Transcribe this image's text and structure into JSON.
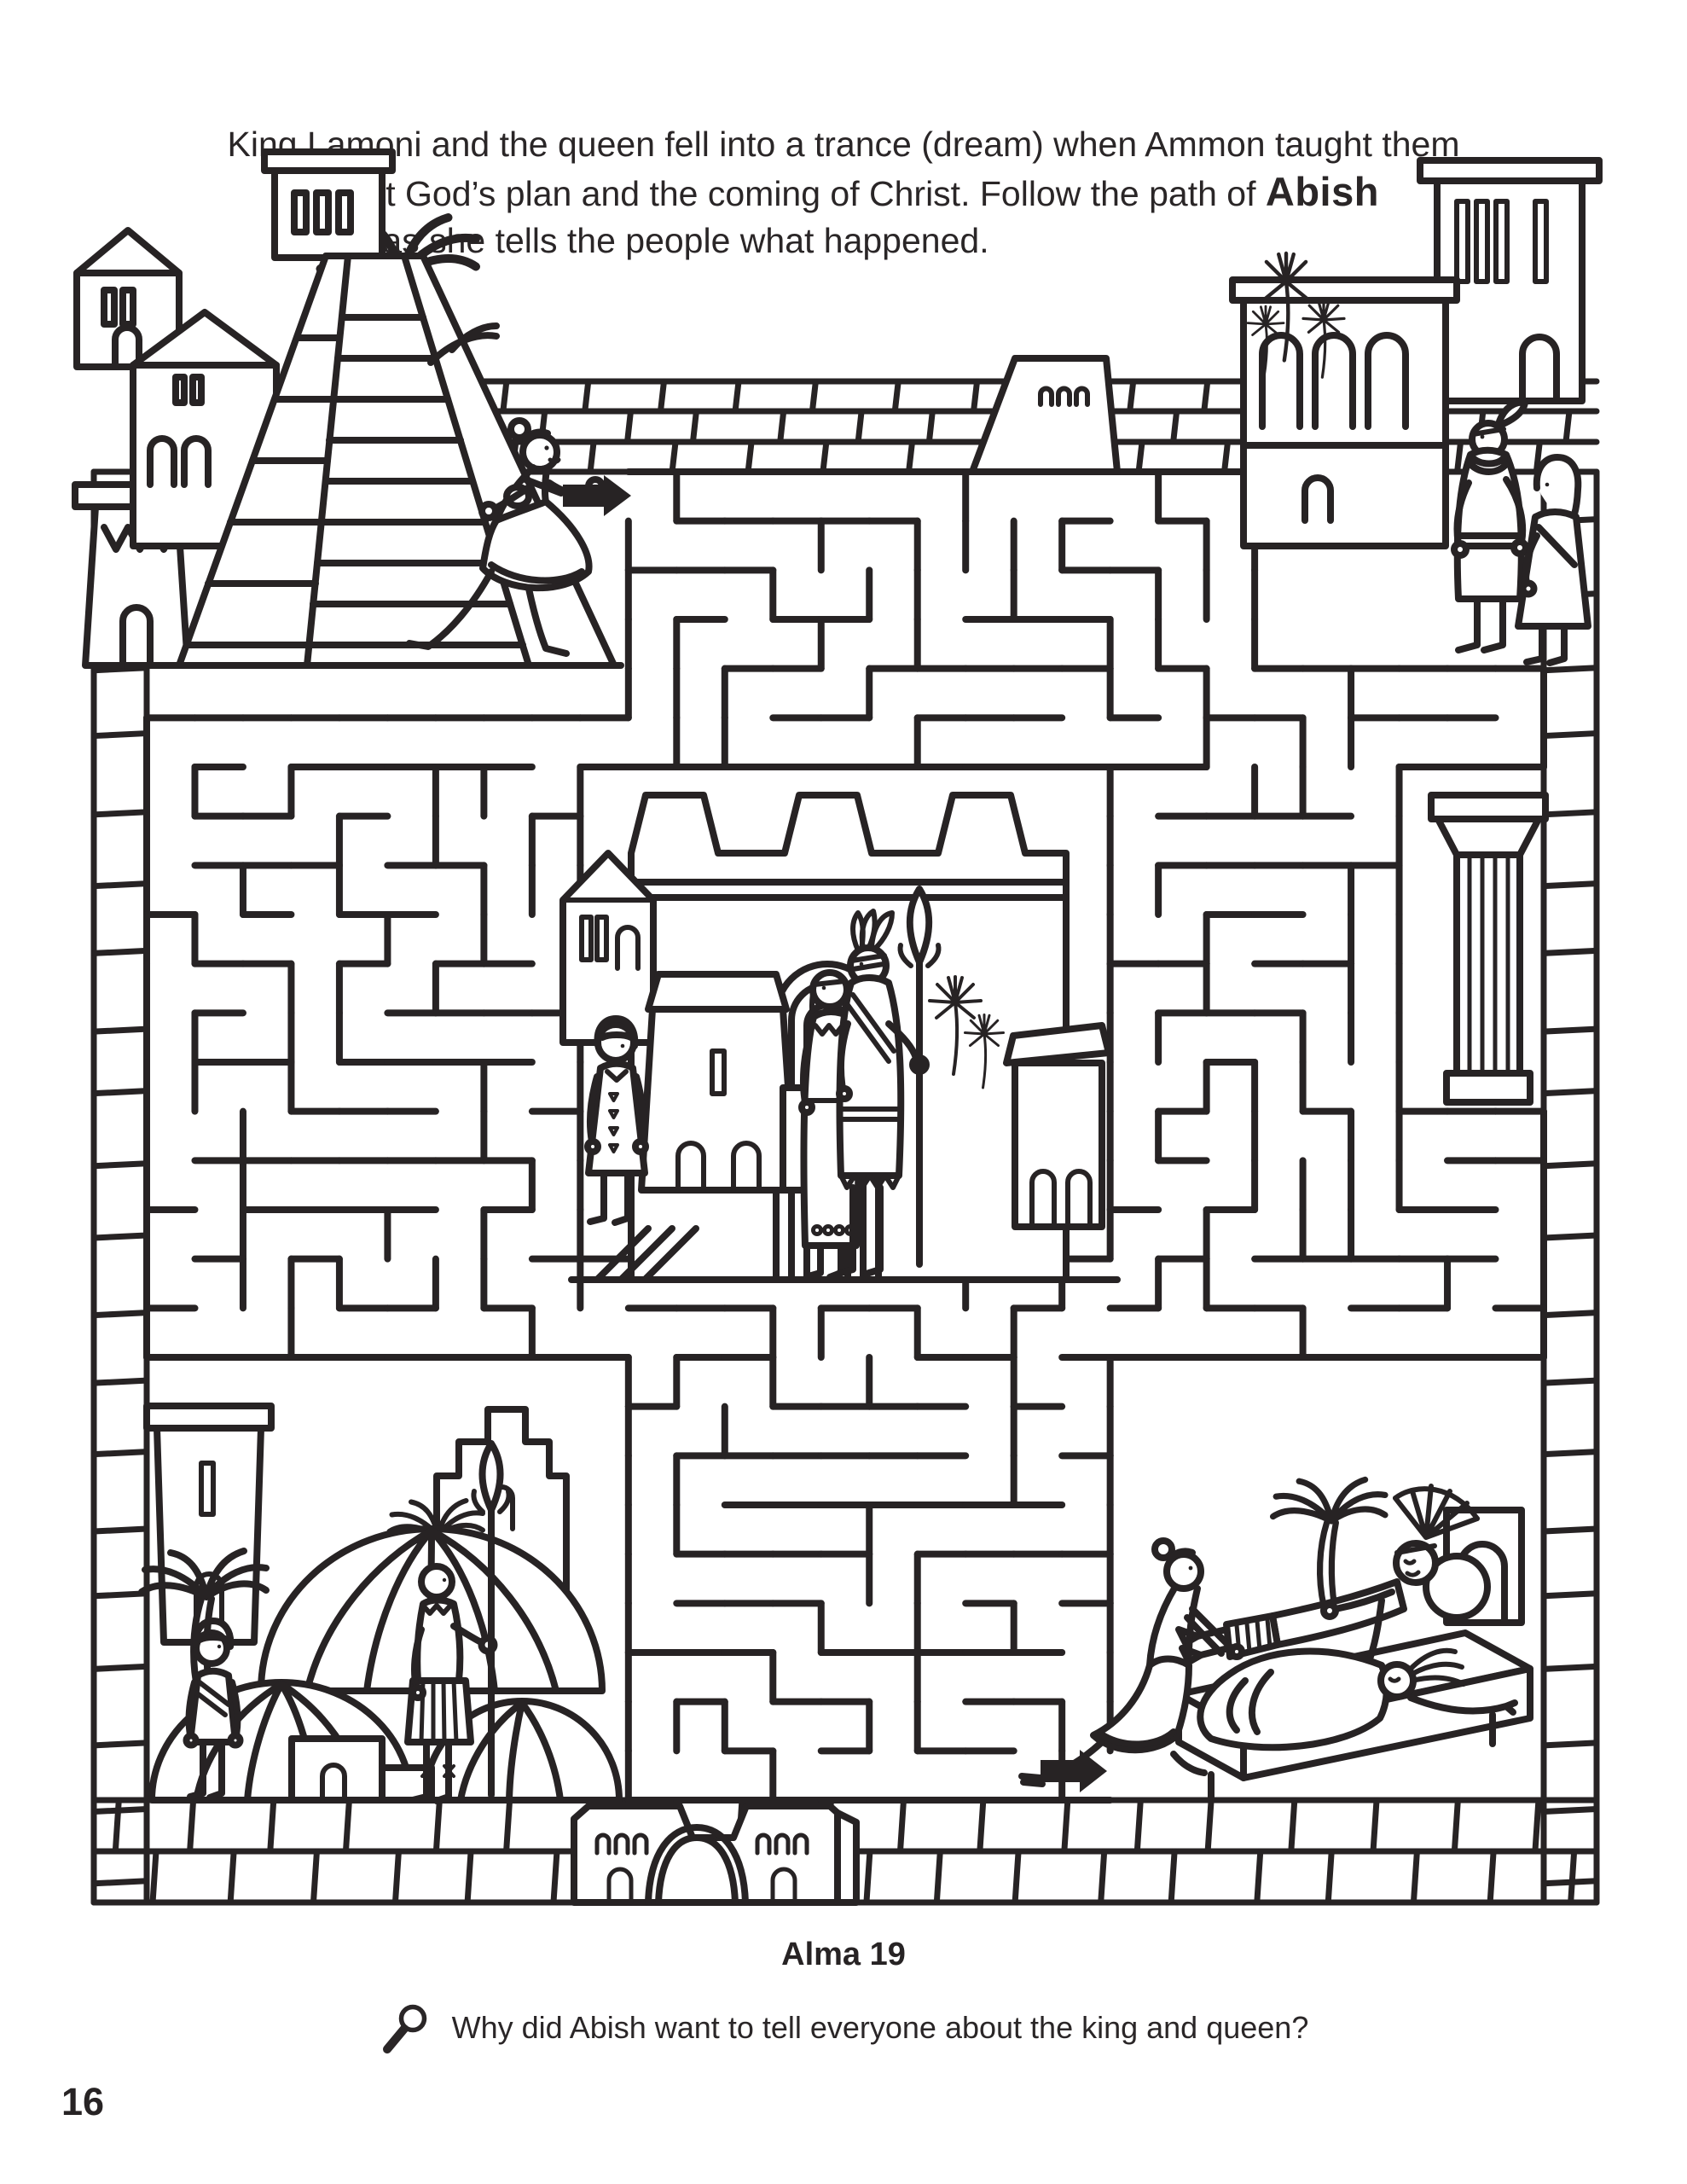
{
  "page": {
    "instructions": {
      "line1": "King Lamoni and the queen fell into a trance (dream) when Ammon taught them",
      "line2_prefix": "about God’s plan and the coming of Christ. Follow the path of ",
      "highlight_name": "Abish",
      "line3": "as she tells the people what happened."
    },
    "scripture_reference": "Alma 19",
    "question": "Why did Abish want to tell everyone about the king and queen?",
    "page_number": "16"
  },
  "maze": {
    "ink_color": "#272324",
    "paper_color": "#ffffff",
    "start_arrow_direction": "right",
    "exit_arrow_direction": "right"
  },
  "icons": {
    "magnifying_glass": "magnifying-glass-icon",
    "start_arrow": "start-arrow-icon",
    "exit_arrow": "exit-arrow-icon"
  }
}
